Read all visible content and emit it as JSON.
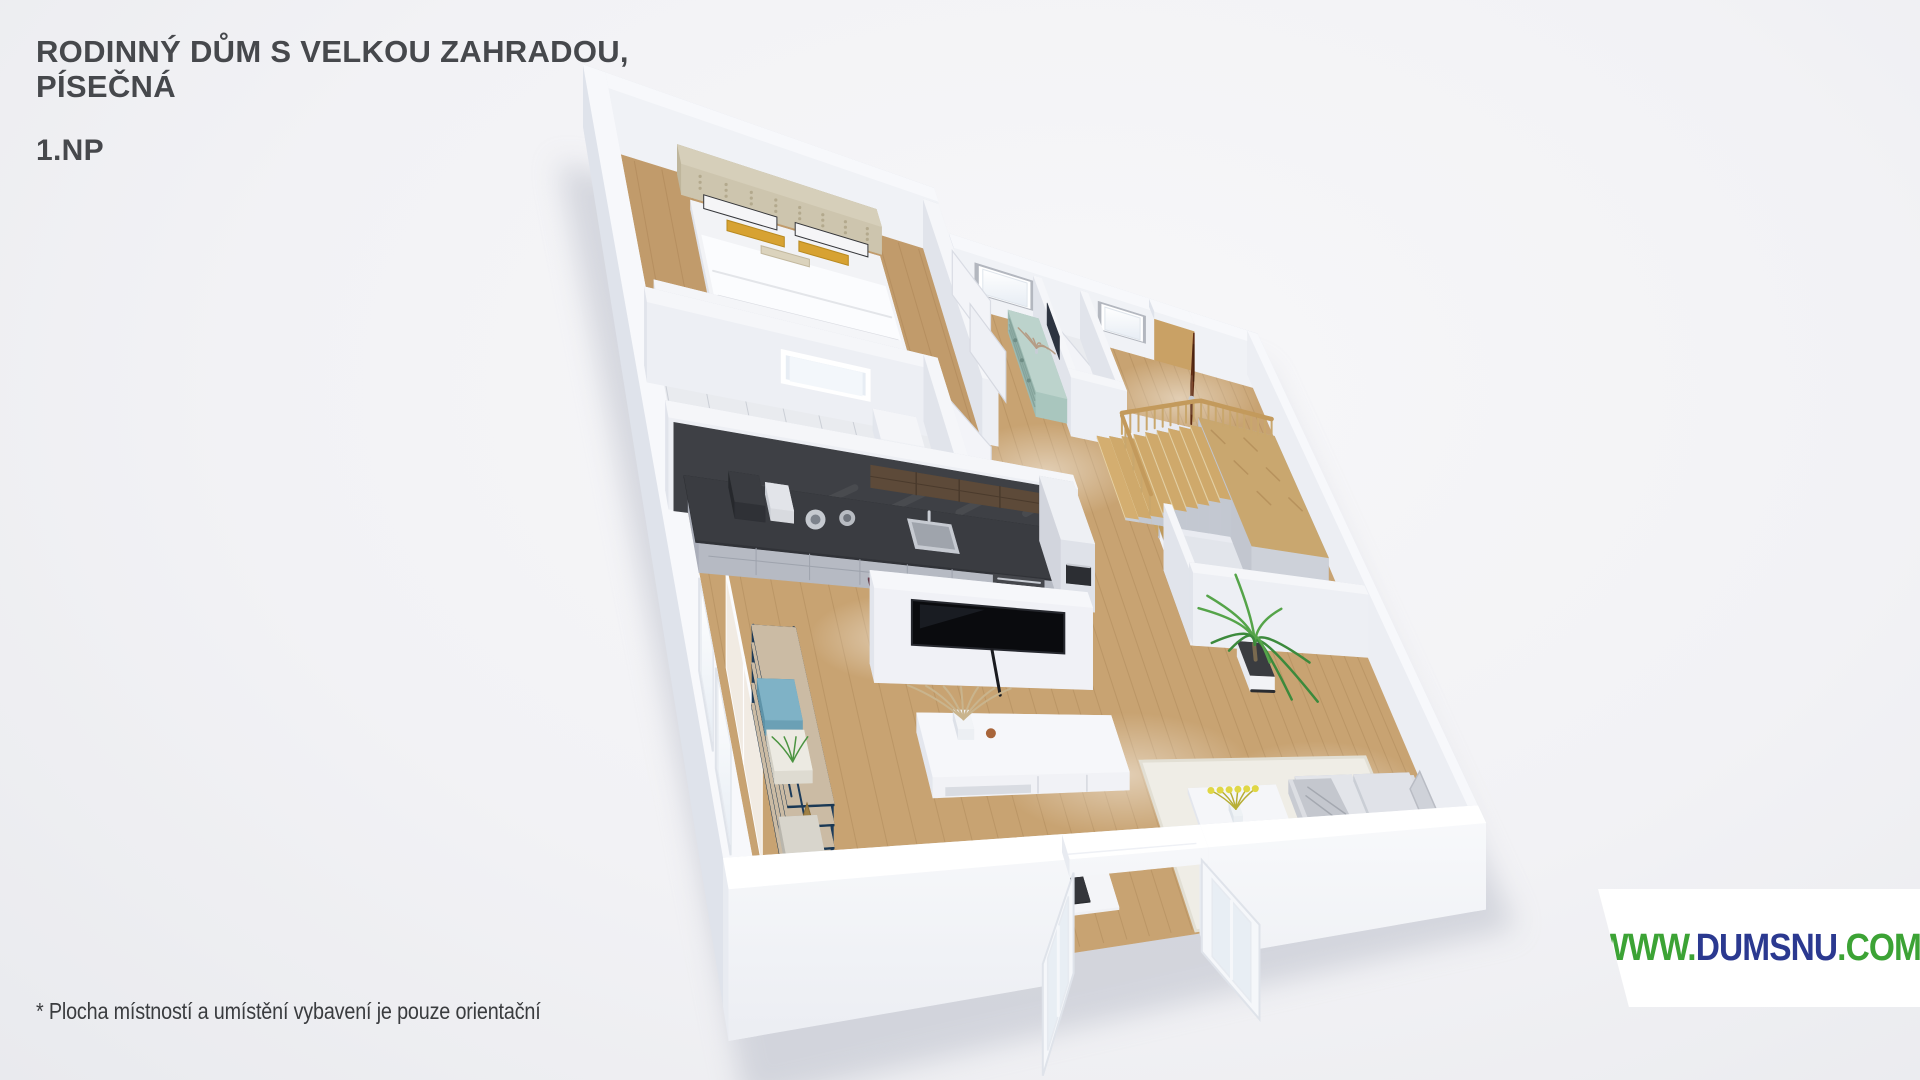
{
  "header": {
    "title_line1": "RODINNÝ DŮM S VELKOU ZAHRADOU,",
    "title_line2": "PÍSEČNÁ",
    "floor_label": "1.NP"
  },
  "footnote": {
    "text": "* Plocha místností a umístění vybavení je pouze orientační"
  },
  "logo": {
    "www": "WWW.",
    "domain": "DUMSNU",
    "tld": ".COM",
    "color_green": "#3ca335",
    "color_navy": "#2b3990"
  },
  "floorplan": {
    "kind": "isometric-3d-floor-plan-render",
    "palette": {
      "background": "#f2f2f5",
      "wall_white": "#f0f2f6",
      "wall_shadow": "#dfe3eb",
      "floor_wood": "#c8a372",
      "stairs_wood": "#c9a265",
      "kitchen_charcoal": "#3e4045",
      "kitchen_cabinet_gray": "#b6bac3",
      "dresser_teal": "#9cbab2",
      "entry_door_brown": "#80401f",
      "shelf_navy": "#1d3c5b",
      "sofa_gray": "#d6d8dd",
      "plant_green": "#3c8a3c",
      "pillow_mustard": "#d7a232",
      "title_gray": "#46484c"
    }
  }
}
